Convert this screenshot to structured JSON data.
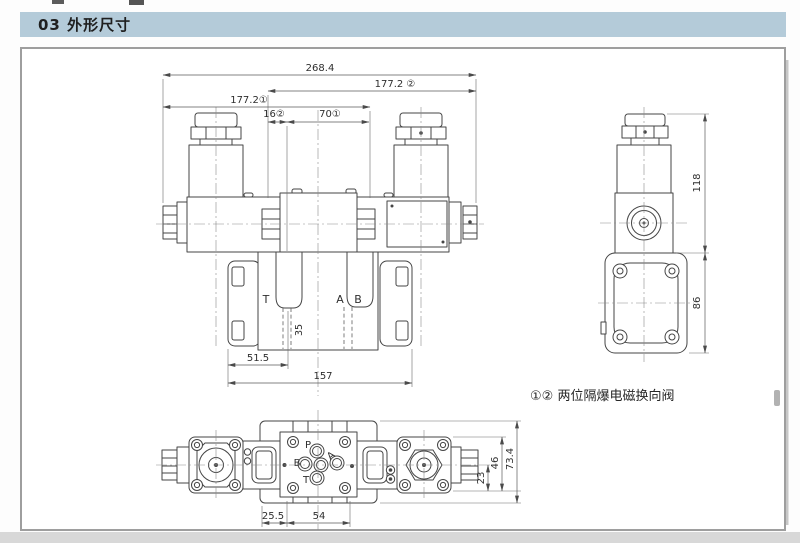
{
  "header": {
    "title": "03 外形尺寸"
  },
  "note": {
    "text": "①② 两位隔爆电磁换向阀"
  },
  "front_view": {
    "dims": {
      "overall": "268.4",
      "width2": "177.2 ②",
      "width1": "177.2①",
      "offset16": "16②",
      "offset70": "70①",
      "d515": "51.5",
      "d157": "157",
      "d35": "35"
    },
    "ports": {
      "t": "T",
      "a": "A",
      "b": "B"
    }
  },
  "side_view": {
    "dims": {
      "h118": "118",
      "h86": "86"
    }
  },
  "bottom_view": {
    "dims": {
      "d255": "25.5",
      "d54": "54",
      "d23": "23",
      "d46": "46",
      "d734": "73.4"
    },
    "ports": {
      "p": "P",
      "a": "A",
      "b": "B",
      "t": "T"
    }
  }
}
